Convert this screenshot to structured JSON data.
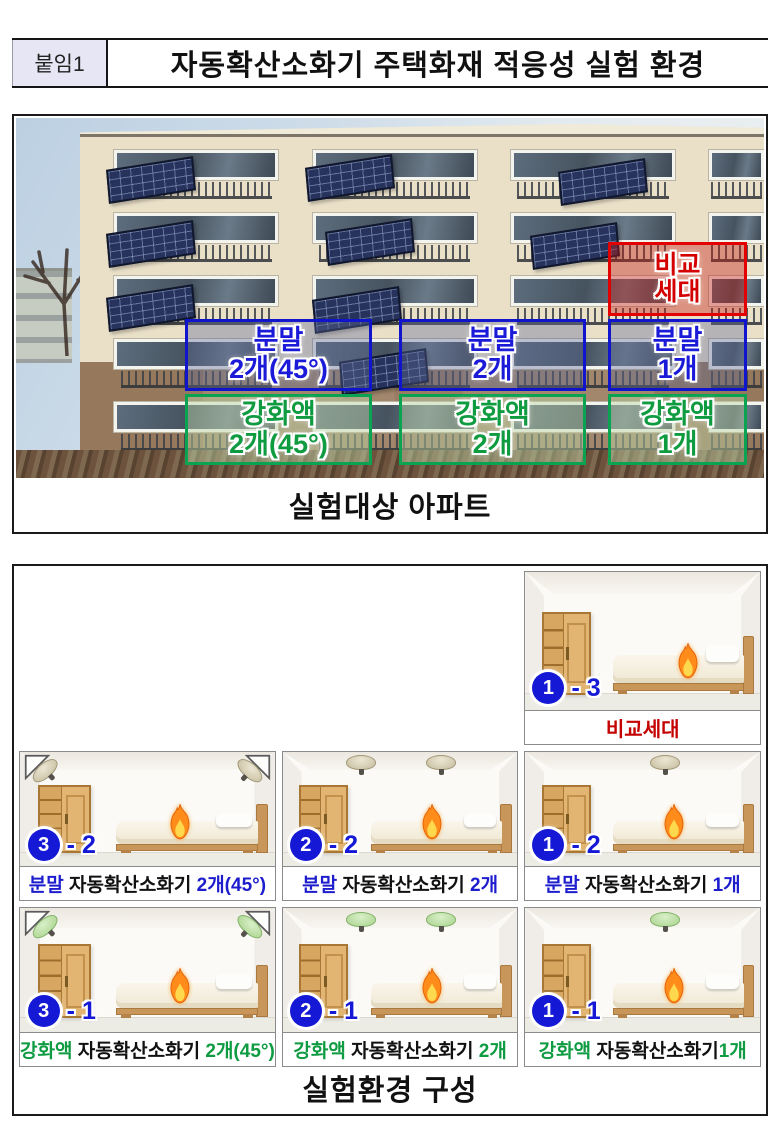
{
  "header": {
    "tag": "붙임1",
    "title": "자동확산소화기 주택화재 적응성 실험 환경"
  },
  "apartment_figure": {
    "caption": "실험대상 아파트",
    "compare_box": {
      "line1": "비교",
      "line2": "세대",
      "color": "#d40000"
    },
    "powder_boxes": [
      {
        "line1": "분말",
        "line2": "2개(45°)"
      },
      {
        "line1": "분말",
        "line2": "2개"
      },
      {
        "line1": "분말",
        "line2": "1개"
      }
    ],
    "liquid_boxes": [
      {
        "line1": "강화액",
        "line2": "2개(45°)"
      },
      {
        "line1": "강화액",
        "line2": "2개"
      },
      {
        "line1": "강화액",
        "line2": "1개"
      }
    ]
  },
  "rooms_figure": {
    "caption": "실험환경 구성",
    "badge_dash": "-",
    "compare_room": {
      "badge_circle": "1",
      "badge_num": "3",
      "caption": "비교세대",
      "extinguishers": "none"
    },
    "powder_rooms": [
      {
        "badge_circle": "3",
        "badge_num": "2",
        "cap_type": "분말",
        "cap_mid": " 자동확산소화기 ",
        "cap_count": "2개(45°)",
        "extinguishers": "powder-corner-2-45deg"
      },
      {
        "badge_circle": "2",
        "badge_num": "2",
        "cap_type": "분말",
        "cap_mid": " 자동확산소화기 ",
        "cap_count": "2개",
        "extinguishers": "powder-ceiling-2"
      },
      {
        "badge_circle": "1",
        "badge_num": "2",
        "cap_type": "분말",
        "cap_mid": " 자동확산소화기 ",
        "cap_count": "1개",
        "extinguishers": "powder-ceiling-1"
      }
    ],
    "liquid_rooms": [
      {
        "badge_circle": "3",
        "badge_num": "1",
        "cap_type": "강화액",
        "cap_mid": " 자동확산소화기 ",
        "cap_count": "2개(45°)",
        "extinguishers": "liquid-corner-2-45deg"
      },
      {
        "badge_circle": "2",
        "badge_num": "1",
        "cap_type": "강화액",
        "cap_mid": " 자동확산소화기 ",
        "cap_count": "2개",
        "extinguishers": "liquid-ceiling-2"
      },
      {
        "badge_circle": "1",
        "badge_num": "1",
        "cap_type": "강화액",
        "cap_mid": " 자동확산소화기",
        "cap_count": "1개",
        "extinguishers": "liquid-ceiling-1"
      }
    ]
  },
  "icons": {
    "fire": "flame-icon",
    "powder_extinguisher": "beige-ceiling-dome",
    "liquid_extinguisher": "green-ceiling-dome",
    "corner_mount": "45deg-triangle-bracket"
  },
  "colors": {
    "powder_blue": "#1d1dce",
    "liquid_green": "#0e9b41",
    "compare_red": "#c40000",
    "badge_blue": "#1519d6",
    "tag_background": "#e6e6f4"
  }
}
